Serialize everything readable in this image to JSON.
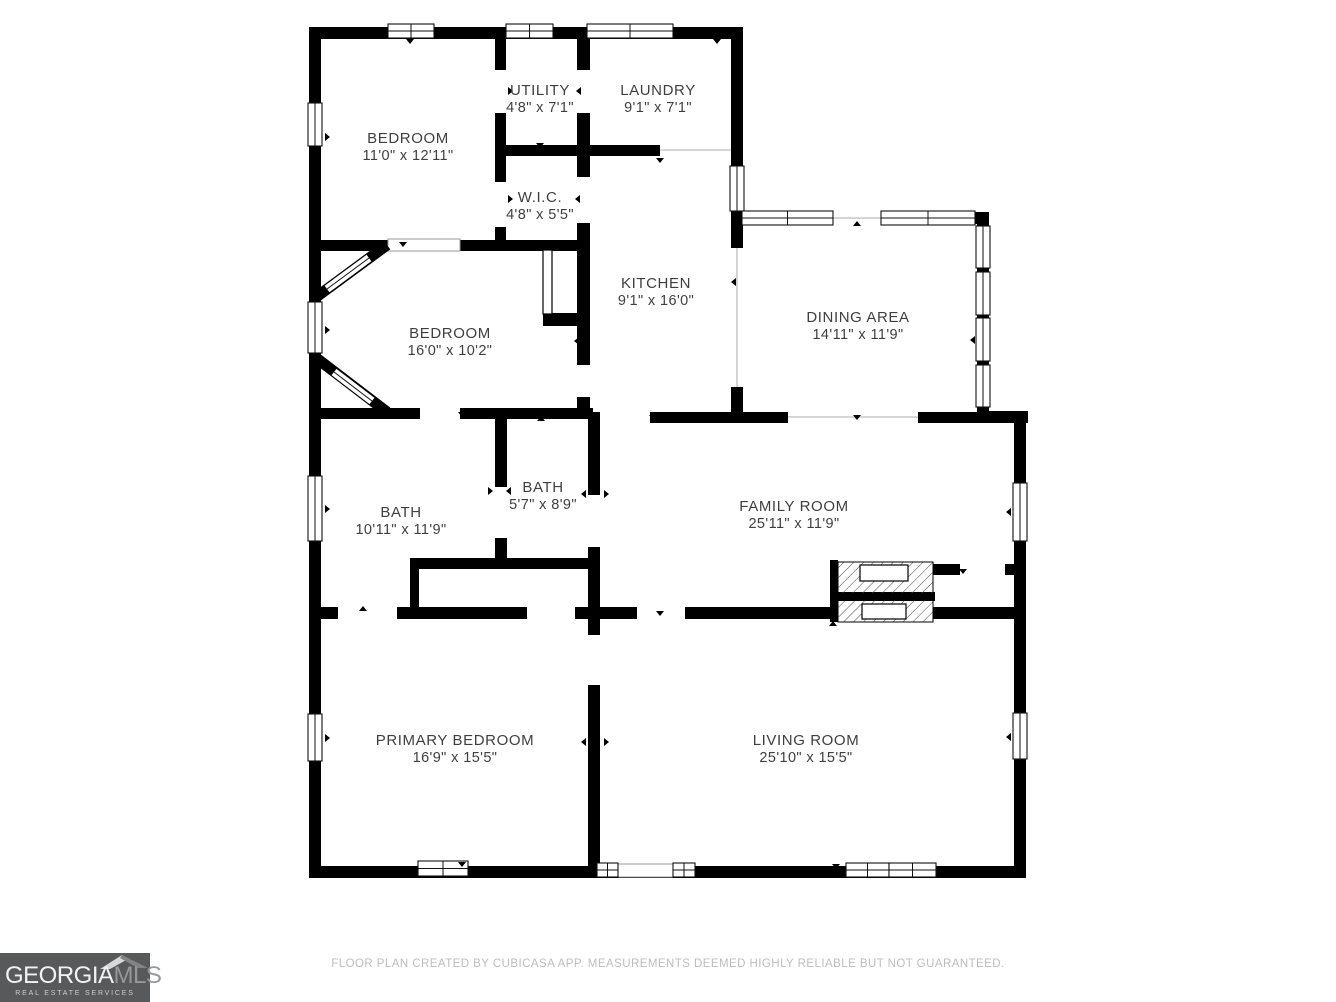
{
  "footer": {
    "disclaimer": "FLOOR PLAN CREATED BY CUBICASA APP. MEASUREMENTS DEEMED HIGHLY RELIABLE BUT NOT GUARANTEED."
  },
  "logo": {
    "brand_primary": "GEORGIA",
    "brand_secondary": "MLS",
    "tagline": "REAL ESTATE SERVICES",
    "bg_color": "#58595b"
  },
  "floorplan": {
    "wall_color": "#000000",
    "label_color": "#3f3f3f",
    "opening_line_color": "#c9c9c9",
    "rooms": [
      {
        "id": "bedroom-1",
        "name": "BEDROOM",
        "dims": "11'0\" x 12'11\"",
        "cx": 408,
        "cy": 143
      },
      {
        "id": "utility",
        "name": "UTILITY",
        "dims": "4'8\" x 7'1\"",
        "cx": 540,
        "cy": 95
      },
      {
        "id": "laundry",
        "name": "LAUNDRY",
        "dims": "9'1\" x 7'1\"",
        "cx": 658,
        "cy": 95
      },
      {
        "id": "wic",
        "name": "W.I.C.",
        "dims": "4'8\" x 5'5\"",
        "cx": 540,
        "cy": 202
      },
      {
        "id": "kitchen",
        "name": "KITCHEN",
        "dims": "9'1\" x 16'0\"",
        "cx": 656,
        "cy": 288
      },
      {
        "id": "dining-area",
        "name": "DINING AREA",
        "dims": "14'11\" x 11'9\"",
        "cx": 858,
        "cy": 322
      },
      {
        "id": "bedroom-2",
        "name": "BEDROOM",
        "dims": "16'0\" x 10'2\"",
        "cx": 450,
        "cy": 338
      },
      {
        "id": "bath-1",
        "name": "BATH",
        "dims": "10'11\" x 11'9\"",
        "cx": 401,
        "cy": 517
      },
      {
        "id": "bath-2",
        "name": "BATH",
        "dims": "5'7\" x 8'9\"",
        "cx": 543,
        "cy": 492
      },
      {
        "id": "family-room",
        "name": "FAMILY ROOM",
        "dims": "25'11\" x 11'9\"",
        "cx": 794,
        "cy": 511
      },
      {
        "id": "primary-bedroom",
        "name": "PRIMARY BEDROOM",
        "dims": "16'9\" x 15'5\"",
        "cx": 455,
        "cy": 745
      },
      {
        "id": "living-room",
        "name": "LIVING ROOM",
        "dims": "25'10\" x 15'5\"",
        "cx": 806,
        "cy": 745
      }
    ],
    "walls": [
      [
        309,
        27,
        434,
        12
      ],
      [
        309,
        27,
        12,
        851
      ],
      [
        309,
        866,
        717,
        12
      ],
      [
        731,
        27,
        12,
        190
      ],
      [
        742,
        212,
        247,
        12
      ],
      [
        977,
        212,
        12,
        206
      ],
      [
        977,
        411,
        51,
        12
      ],
      [
        1014,
        411,
        12,
        467
      ],
      [
        495,
        38,
        11,
        213
      ],
      [
        577,
        38,
        13,
        374
      ],
      [
        309,
        240,
        281,
        11
      ],
      [
        495,
        145,
        165,
        11
      ],
      [
        543,
        313,
        47,
        13
      ],
      [
        731,
        213,
        12,
        199
      ],
      [
        588,
        412,
        200,
        11
      ],
      [
        918,
        412,
        110,
        11
      ],
      [
        309,
        408,
        284,
        11
      ],
      [
        495,
        418,
        12,
        150
      ],
      [
        588,
        413,
        12,
        453
      ],
      [
        410,
        558,
        183,
        11
      ],
      [
        410,
        558,
        9,
        61
      ],
      [
        309,
        607,
        524,
        12
      ],
      [
        933,
        607,
        93,
        12
      ],
      [
        933,
        564,
        27,
        11
      ],
      [
        1005,
        564,
        11,
        11
      ],
      [
        830,
        560,
        8,
        62
      ],
      [
        830,
        592,
        105,
        9
      ]
    ],
    "gaps": [
      [
        495,
        70,
        11,
        43
      ],
      [
        577,
        70,
        13,
        43
      ],
      [
        495,
        182,
        11,
        45
      ],
      [
        577,
        177,
        13,
        46
      ],
      [
        577,
        365,
        13,
        32
      ],
      [
        731,
        248,
        12,
        139
      ],
      [
        600,
        412,
        50,
        11
      ],
      [
        833,
        212,
        48,
        12
      ],
      [
        420,
        408,
        40,
        11
      ],
      [
        495,
        487,
        12,
        51
      ],
      [
        588,
        495,
        12,
        52
      ],
      [
        588,
        635,
        12,
        50
      ],
      [
        338,
        607,
        59,
        12
      ],
      [
        527,
        607,
        48,
        12
      ],
      [
        637,
        607,
        48,
        12
      ],
      [
        960,
        564,
        45,
        11
      ],
      [
        660,
        145,
        71,
        11
      ]
    ],
    "opening_lines": [
      [
        833,
        218,
        881,
        218
      ],
      [
        660,
        150,
        731,
        150
      ],
      [
        737,
        248,
        737,
        387
      ],
      [
        788,
        417,
        918,
        417
      ]
    ],
    "outlined_gaps": [
      [
        388,
        239,
        72,
        12
      ],
      [
        618,
        864,
        56,
        13
      ]
    ],
    "windows_h": [
      [
        388,
        24,
        46,
        14
      ],
      [
        506,
        24,
        47,
        14
      ],
      [
        587,
        24,
        86,
        14
      ],
      [
        742,
        211,
        91,
        14
      ],
      [
        881,
        211,
        94,
        14
      ],
      [
        418,
        861,
        50,
        15
      ],
      [
        846,
        863,
        43,
        14
      ],
      [
        889,
        863,
        47,
        14
      ]
    ],
    "windows_v": [
      [
        308,
        103,
        14,
        43
      ],
      [
        308,
        302,
        14,
        51
      ],
      [
        308,
        476,
        14,
        65
      ],
      [
        308,
        714,
        14,
        47
      ],
      [
        730,
        166,
        14,
        45
      ],
      [
        976,
        226,
        14,
        42
      ],
      [
        976,
        272,
        14,
        43
      ],
      [
        976,
        318,
        14,
        43
      ],
      [
        976,
        365,
        14,
        42
      ],
      [
        1013,
        483,
        14,
        58
      ],
      [
        1013,
        713,
        14,
        46
      ]
    ],
    "small_windows": [
      [
        597,
        863,
        21,
        14
      ],
      [
        673,
        863,
        22,
        14
      ]
    ],
    "door_leaf": [
      543,
      250,
      9,
      64
    ],
    "diagonal_walls": [
      {
        "x1": 387,
        "y1": 245,
        "x2": 315,
        "y2": 298,
        "wx1": 369,
        "wy1": 258,
        "wx2": 327,
        "wy2": 289
      },
      {
        "x1": 315,
        "y1": 357,
        "x2": 387,
        "y2": 412,
        "wx1": 334,
        "wy1": 372,
        "wx2": 372,
        "wy2": 401
      }
    ],
    "fireplace": {
      "hatch_rects": [
        [
          838,
          562,
          95,
          32
        ],
        [
          838,
          600,
          95,
          22
        ]
      ],
      "insets": [
        [
          860,
          565,
          48,
          16
        ],
        [
          862,
          604,
          44,
          15
        ]
      ]
    },
    "markers": [
      [
        410,
        39,
        "down"
      ],
      [
        717,
        39,
        "down"
      ],
      [
        325,
        137,
        "right"
      ],
      [
        325,
        330,
        "right"
      ],
      [
        325,
        509,
        "right"
      ],
      [
        325,
        738,
        "right"
      ],
      [
        508,
        91,
        "right"
      ],
      [
        581,
        91,
        "left"
      ],
      [
        540,
        143,
        "down"
      ],
      [
        508,
        199,
        "right"
      ],
      [
        580,
        199,
        "left"
      ],
      [
        561,
        244,
        "down"
      ],
      [
        403,
        242,
        "down"
      ],
      [
        660,
        158,
        "down"
      ],
      [
        857,
        226,
        "up"
      ],
      [
        736,
        282,
        "left"
      ],
      [
        975,
        340,
        "left"
      ],
      [
        462,
        412,
        "down"
      ],
      [
        541,
        421,
        "up"
      ],
      [
        579,
        341,
        "left"
      ],
      [
        653,
        415,
        "down"
      ],
      [
        857,
        415,
        "down"
      ],
      [
        715,
        421,
        "up"
      ],
      [
        488,
        491,
        "right"
      ],
      [
        511,
        491,
        "left"
      ],
      [
        586,
        494,
        "left"
      ],
      [
        604,
        494,
        "right"
      ],
      [
        545,
        562,
        "down"
      ],
      [
        363,
        611,
        "up"
      ],
      [
        458,
        619,
        "up"
      ],
      [
        660,
        611,
        "down"
      ],
      [
        715,
        610,
        "down"
      ],
      [
        586,
        742,
        "left"
      ],
      [
        604,
        742,
        "right"
      ],
      [
        1011,
        512,
        "left"
      ],
      [
        1011,
        737,
        "left"
      ],
      [
        836,
        864,
        "down"
      ],
      [
        462,
        862,
        "down"
      ],
      [
        963,
        569,
        "down"
      ],
      [
        833,
        626,
        "up"
      ]
    ]
  }
}
